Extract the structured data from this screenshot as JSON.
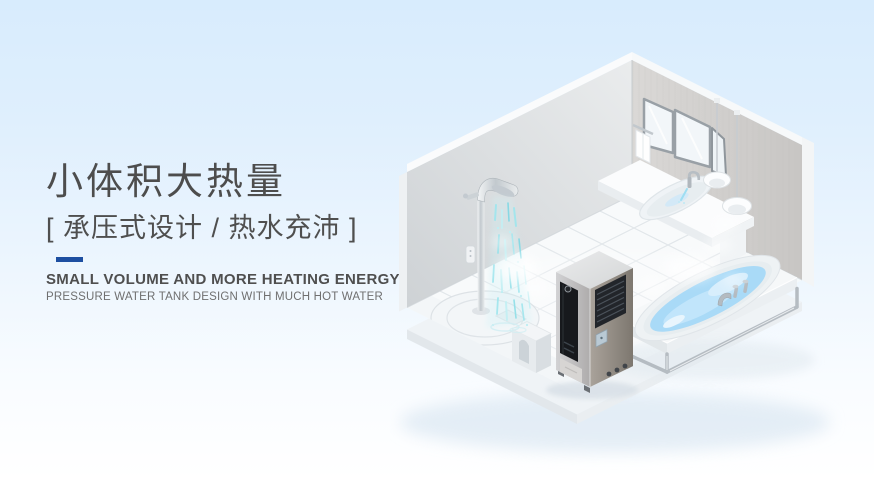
{
  "banner": {
    "width": 874,
    "height": 480,
    "background_top": "#d8ecfd",
    "background_bottom": "#ffffff"
  },
  "headline": {
    "title": "小体积大热量",
    "subtitle": "[ 承压式设计 / 热水充沛 ]",
    "en_title": "SMALL VOLUME AND MORE HEATING ENERGY",
    "en_subtitle": "PRESSURE WATER TANK DESIGN WITH MUCH HOT WATER",
    "divider_color": "#1d4fa1",
    "text_color": "#4d4d4d"
  },
  "illustration": {
    "type": "isometric-bathroom-render",
    "items": [
      {
        "name": "left-wall"
      },
      {
        "name": "right-wall"
      },
      {
        "name": "tiled-floor"
      },
      {
        "name": "shower-column",
        "detail": "chrome shower spraying hot water with steam"
      },
      {
        "name": "shower-tray"
      },
      {
        "name": "toilet-stool"
      },
      {
        "name": "heat-pump-water-heater",
        "detail": "tall metallic tank, black control panel, air vent grille"
      },
      {
        "name": "bathtub",
        "detail": "oval tub with blue water on framed platform"
      },
      {
        "name": "vanity-sink",
        "detail": "wall-hung basin with running faucet"
      },
      {
        "name": "folding-mirror",
        "panels": 3
      },
      {
        "name": "pendant-lamps",
        "count": 2
      },
      {
        "name": "towel"
      },
      {
        "name": "steam-wisps"
      }
    ],
    "colors": {
      "water": "#a9daf7",
      "spray": "#9fe6ee",
      "wall_left": "#d8dcde",
      "wall_right": "#cfcdcb",
      "heater_body": "#8e8881",
      "heater_panel": "#17191d",
      "chrome": "#c2c9ce"
    }
  }
}
